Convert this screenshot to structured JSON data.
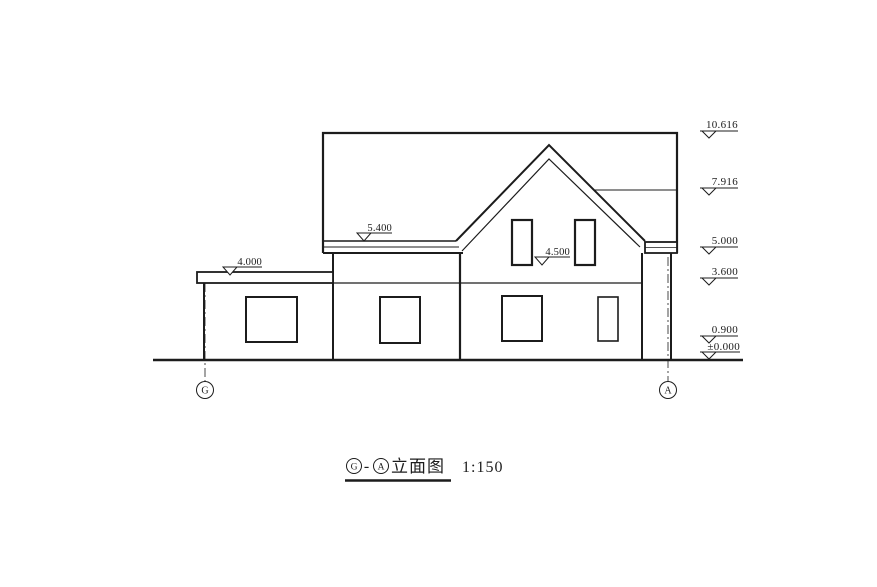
{
  "drawing": {
    "title": {
      "axis_start": "G",
      "separator": "-",
      "axis_end": "A",
      "name": "立面图",
      "scale": "1:150"
    },
    "elevation_markers": [
      {
        "label": "10.616"
      },
      {
        "label": "7.916"
      },
      {
        "label": "5.000"
      },
      {
        "label": "3.600"
      },
      {
        "label": "0.900"
      },
      {
        "label": "±0.000"
      }
    ],
    "inline_markers": [
      {
        "label": "5.400"
      },
      {
        "label": "4.000"
      },
      {
        "label": "4.500"
      }
    ],
    "axis_bubbles": {
      "left": "G",
      "right": "A"
    },
    "colors": {
      "line": "#1c1c1c",
      "background": "#ffffff"
    }
  }
}
